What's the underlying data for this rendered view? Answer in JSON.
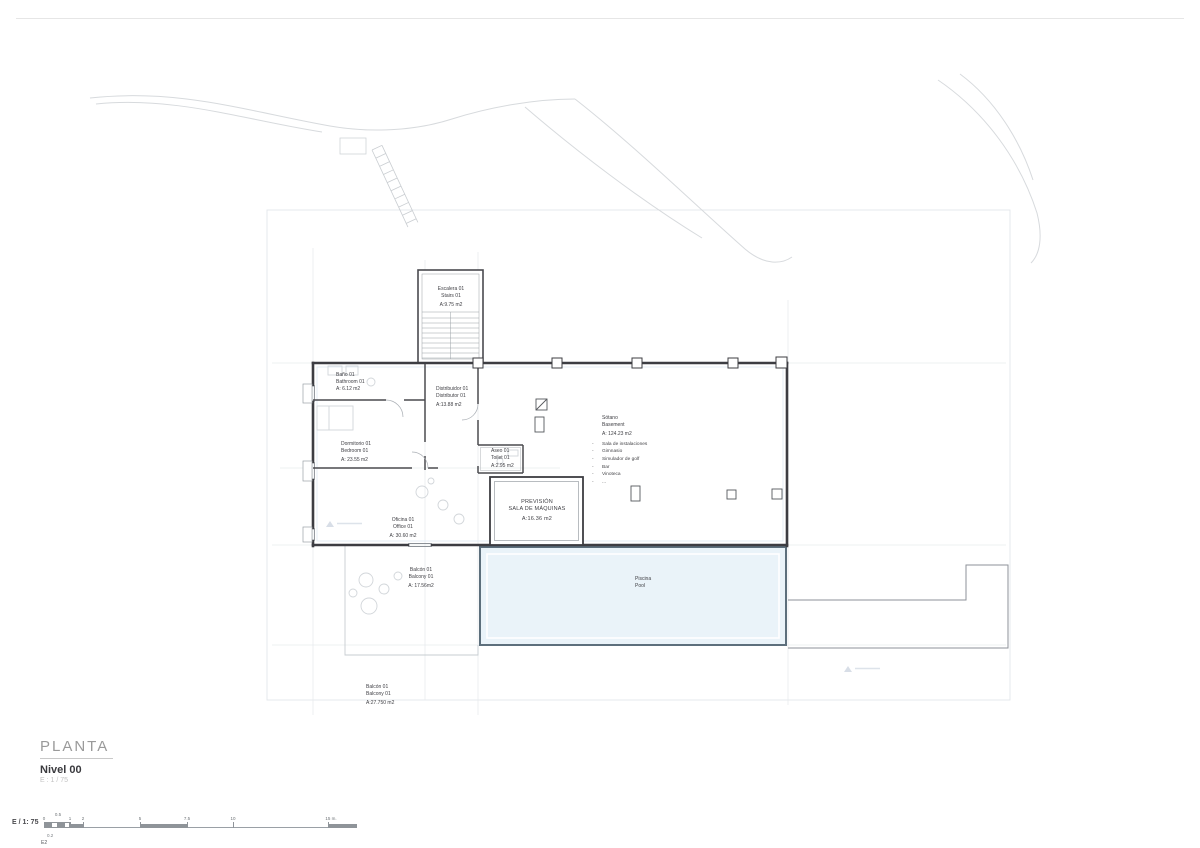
{
  "sheet": {
    "title": "PLANTA",
    "level": "Nivel 00",
    "scale_note": "E : 1 / 75"
  },
  "scale_bar": {
    "label": "E / 1: 75",
    "ticks": [
      "0",
      "0.5",
      "1",
      "2",
      "5",
      "7.5",
      "10",
      "15 m."
    ],
    "sub_label": "0.2",
    "sheet_ref": "E2"
  },
  "rooms": {
    "escalera": {
      "name_es": "Escalera 01",
      "name_en": "Stairs 01",
      "area": "A:9.75 m2"
    },
    "bano": {
      "name_es": "Baño 01",
      "name_en": "Bathroom 01",
      "area": "A: 6.12 m2"
    },
    "distribuidor": {
      "name_es": "Distribuidor 01",
      "name_en": "Distributor 01",
      "area": "A:13.88 m2"
    },
    "dormitorio": {
      "name_es": "Dormitorio 01",
      "name_en": "Bedroom 01",
      "area": "A: 23.55 m2"
    },
    "aseo": {
      "name_es": "Aseo 01",
      "name_en": "Toilet 01",
      "area": "A:2.95 m2"
    },
    "sotano": {
      "name_es": "Sótano",
      "name_en": "Basement",
      "area": "A: 124.23 m2"
    },
    "prevision": {
      "line1": "PREVISIÓN",
      "line2": "SALA DE MÁQUINAS",
      "area": "A:16.36 m2"
    },
    "oficina": {
      "name_es": "Oficina 01",
      "name_en": "Office 01",
      "area": "A: 30.60 m2"
    },
    "balcon": {
      "name_es": "Balcón 01",
      "name_en": "Balcony 01",
      "area": "A: 17.56m2"
    },
    "piscina": {
      "name_es": "Piscina",
      "name_en": "Pool"
    },
    "balcon_lower": {
      "name_es": "Balcón 01",
      "name_en": "Balcony 01",
      "area": "A:27.750 m2"
    }
  },
  "basement_features": [
    "Sala de instalaciones",
    "Gimnasio",
    "Simulador de golf",
    "Bar",
    "Vinoteca",
    "..."
  ]
}
